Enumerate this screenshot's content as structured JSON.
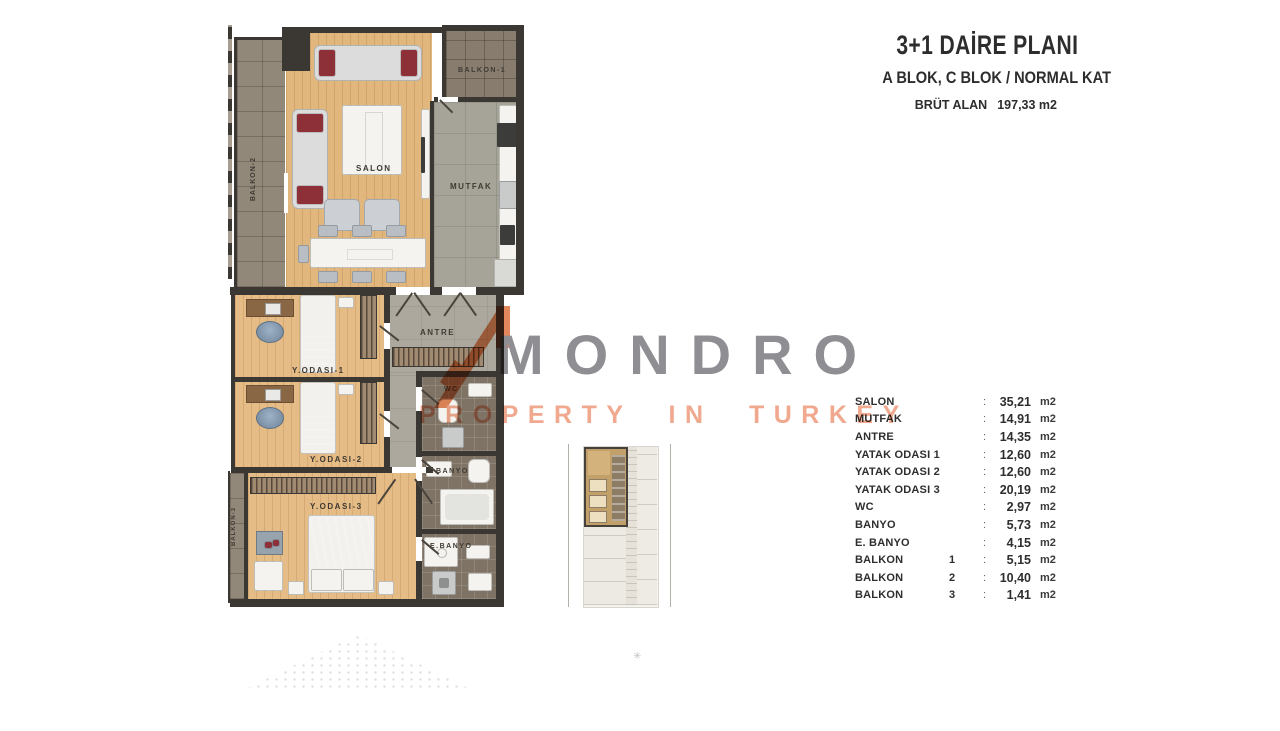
{
  "header": {
    "title": "3+1 DAİRE PLANI",
    "subtitle": "A BLOK, C BLOK / NORMAL KAT",
    "gross_area_label": "BRÜT ALAN",
    "gross_area_value": "197,33 m2"
  },
  "watermark": {
    "brand": "MONDRO",
    "tagline": "PROPERTY IN TURKEY"
  },
  "plan": {
    "rooms": {
      "salon": "SALON",
      "mutfak": "MUTFAK",
      "antre": "ANTRE",
      "wc": "WC",
      "banyo": "BANYO",
      "ebanyo": "E.BANYO",
      "balkon1": "BALKON-1",
      "balkon2": "BALKON-2",
      "balkon3": "BALKON-3",
      "yodasi1": "Y.ODASI-1",
      "yodasi2": "Y.ODASI-2",
      "yodasi3": "Y.ODASI-3"
    }
  },
  "area_table": {
    "separator": ":",
    "rows": [
      {
        "label": "SALON",
        "num": "",
        "value": "35,21",
        "unit": "m2"
      },
      {
        "label": "MUTFAK",
        "num": "",
        "value": "14,91",
        "unit": "m2"
      },
      {
        "label": "ANTRE",
        "num": "",
        "value": "14,35",
        "unit": "m2"
      },
      {
        "label": "YATAK ODASI 1",
        "num": "",
        "value": "12,60",
        "unit": "m2"
      },
      {
        "label": "YATAK ODASI 2",
        "num": "",
        "value": "12,60",
        "unit": "m2"
      },
      {
        "label": "YATAK ODASI 3",
        "num": "",
        "value": "20,19",
        "unit": "m2"
      },
      {
        "label": "WC",
        "num": "",
        "value": "2,97",
        "unit": "m2"
      },
      {
        "label": "BANYO",
        "num": "",
        "value": "5,73",
        "unit": "m2"
      },
      {
        "label": "E. BANYO",
        "num": "",
        "value": "4,15",
        "unit": "m2"
      },
      {
        "label": "BALKON",
        "num": "1",
        "value": "5,15",
        "unit": "m2"
      },
      {
        "label": "BALKON",
        "num": "2",
        "value": "10,40",
        "unit": "m2"
      },
      {
        "label": "BALKON",
        "num": "3",
        "value": "1,41",
        "unit": "m2"
      }
    ]
  },
  "marks": {
    "asterisk": "✳"
  },
  "colors": {
    "wall": "#3b3733",
    "wood_floor": "#e2b77e",
    "balcony_tile": "#92887a",
    "accent_orange": "#dd7440",
    "tagline_salmon": "#f0a98e",
    "brand_gray": "#8f8f93"
  }
}
